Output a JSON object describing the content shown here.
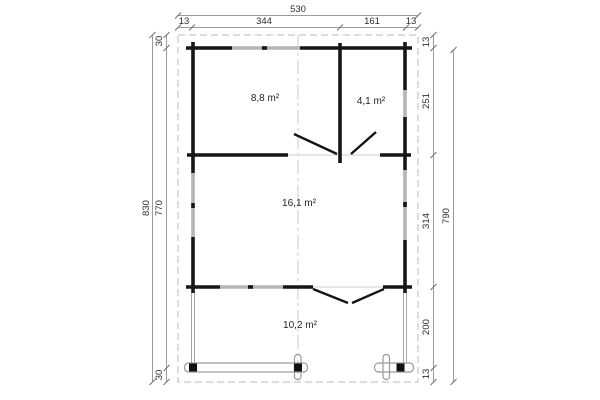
{
  "drawing": {
    "type": "floor-plan",
    "rooms": [
      {
        "label": "8,8 m²"
      },
      {
        "label": "4,1 m²"
      },
      {
        "label": "16,1 m²"
      },
      {
        "label": "10,2 m²"
      }
    ],
    "dimensions": {
      "top_total": "530",
      "top_segments": [
        "13",
        "344",
        "161",
        "13"
      ],
      "left_overall": "830",
      "left_segments": [
        "30",
        "770",
        "30"
      ],
      "right_segments": [
        "13",
        "251",
        "314",
        "200",
        "13"
      ],
      "right_overall": "790"
    },
    "colors": {
      "wall": "#161616",
      "window": "#b5b5b5",
      "dimension_line": "#9b9b9b",
      "text": "#2e2e2e",
      "dashed_guide": "#c6c6c6",
      "background": "#ffffff"
    }
  }
}
